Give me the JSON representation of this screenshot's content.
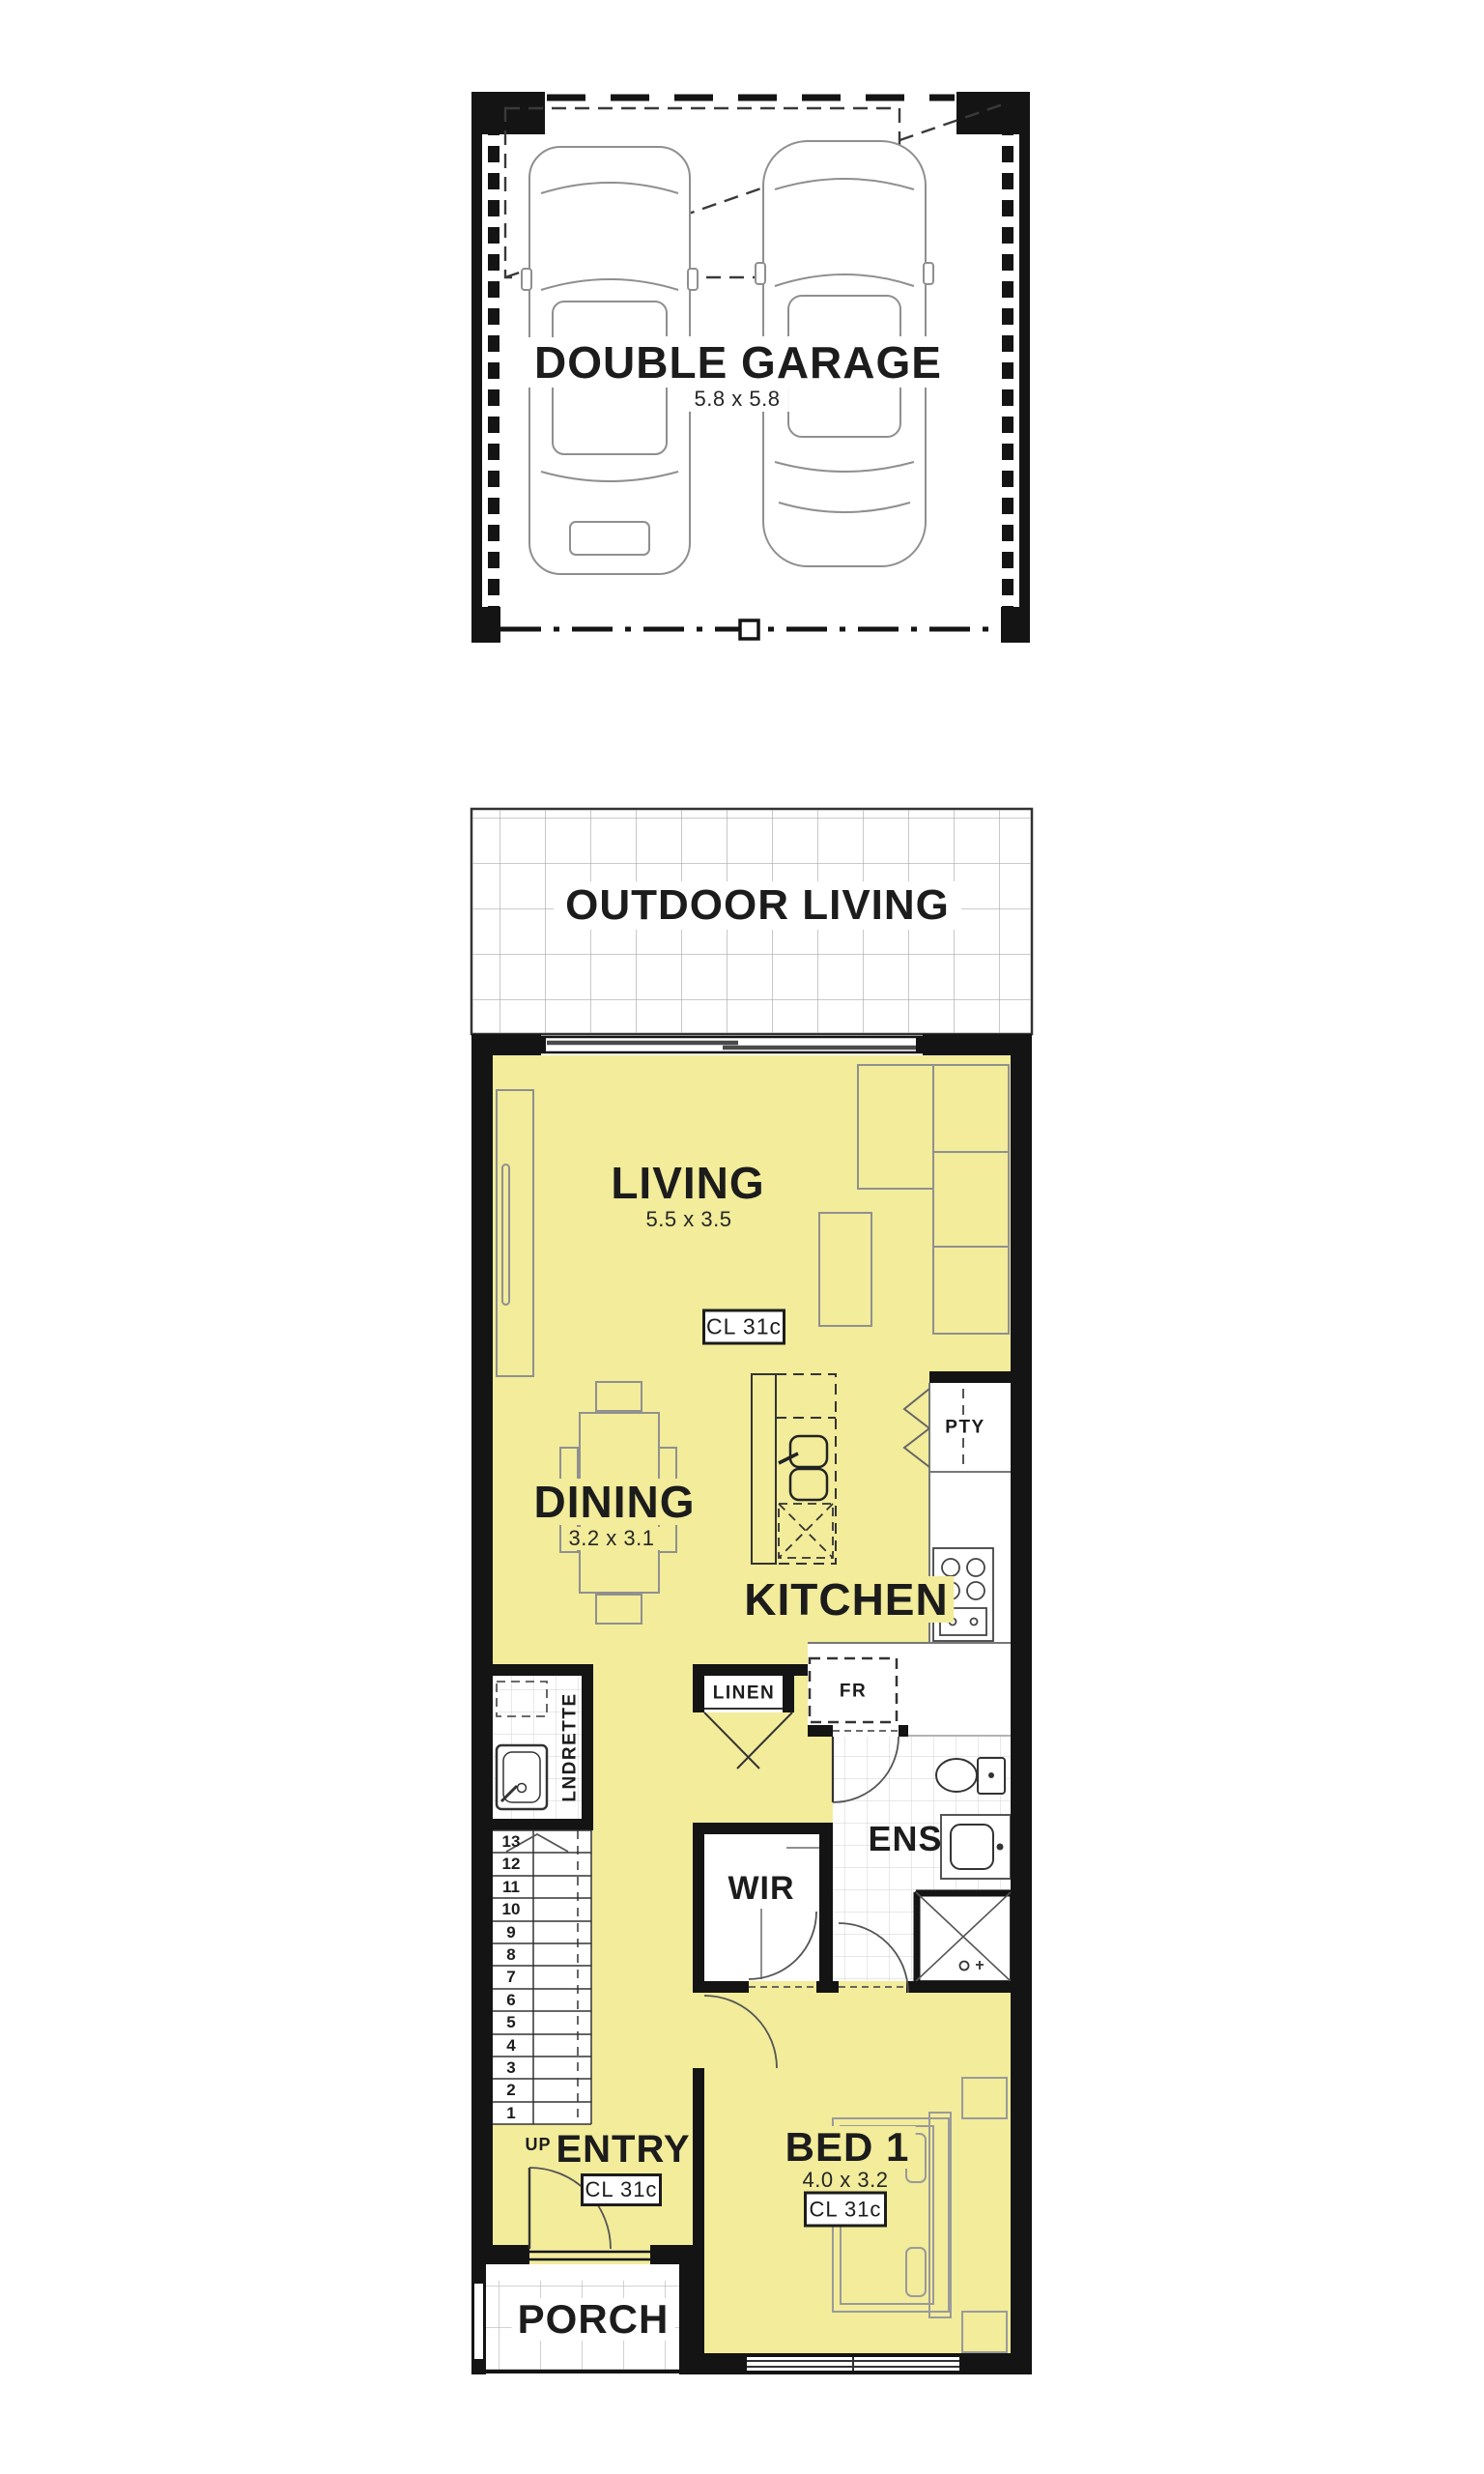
{
  "plan": {
    "colors": {
      "room_fill": "#F2EC9B",
      "wall": "#141414",
      "tile_line": "#cfcfcf",
      "grid_line": "#ababab"
    },
    "garage": {
      "label": "DOUBLE GARAGE",
      "dims": "5.8 x 5.8"
    },
    "outdoor": {
      "label": "OUTDOOR LIVING"
    },
    "living": {
      "label": "LIVING",
      "dims": "5.5 x 3.5",
      "ceiling": "CL 31c"
    },
    "dining": {
      "label": "DINING",
      "dims": "3.2 x 3.1"
    },
    "kitchen": {
      "label": "KITCHEN",
      "pantry": "PTY",
      "fridge": "FR",
      "linen": "LINEN"
    },
    "laundrette": {
      "label": "LNDRETTE"
    },
    "ensuite": {
      "label": "ENS"
    },
    "wir": {
      "label": "WIR"
    },
    "stairs": {
      "up": "UP",
      "numbers": [
        "13",
        "12",
        "11",
        "10",
        "9",
        "8",
        "7",
        "6",
        "5",
        "4",
        "3",
        "2",
        "1"
      ]
    },
    "entry": {
      "label": "ENTRY",
      "ceiling": "CL 31c"
    },
    "bed1": {
      "label": "BED 1",
      "dims": "4.0 x 3.2",
      "ceiling": "CL 31c"
    },
    "porch": {
      "label": "PORCH"
    }
  }
}
